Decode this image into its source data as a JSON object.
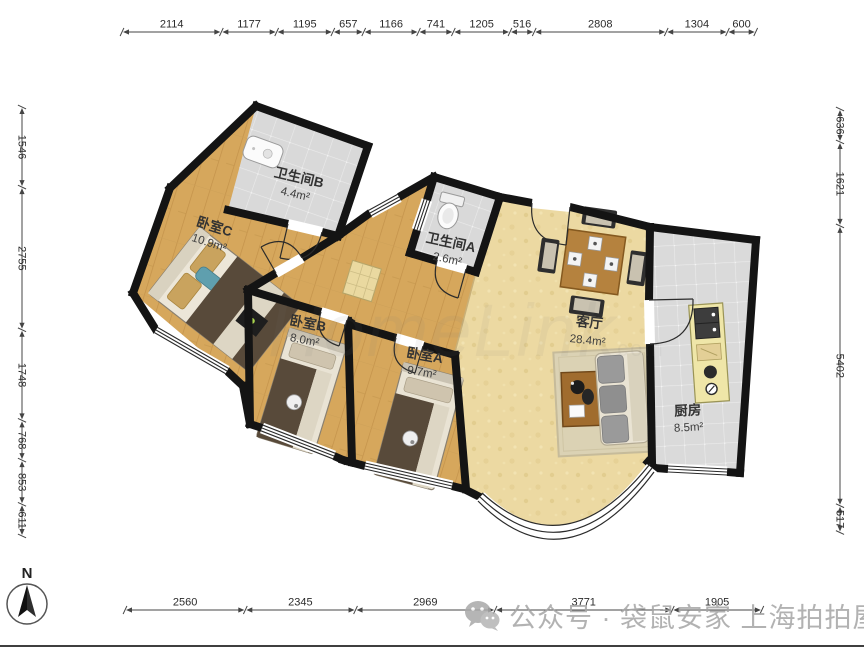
{
  "rooms": [
    {
      "name": "卫生间B",
      "area": "4.4m²"
    },
    {
      "name": "卧室C",
      "area": "10.9m²"
    },
    {
      "name": "卫生间A",
      "area": "2.6m²"
    },
    {
      "name": "卧室B",
      "area": "8.0m²"
    },
    {
      "name": "卧室A",
      "area": "9.7m²"
    },
    {
      "name": "客厅",
      "area": "28.4m²"
    },
    {
      "name": "厨房",
      "area": "8.5m²"
    }
  ],
  "dimensions": {
    "top": [
      2114,
      1177,
      1195,
      657,
      1166,
      741,
      1205,
      516,
      2808,
      1304,
      600
    ],
    "left": [
      1546,
      2755,
      1748,
      768,
      853,
      611
    ],
    "right": [
      636,
      1621,
      5402,
      517
    ],
    "bottom": [
      2560,
      2345,
      2969,
      3771,
      1905
    ]
  },
  "compass": {
    "label": "N"
  },
  "watermark": {
    "bottom_text": "公众号 · 袋鼠安家 上海拍拍屋",
    "center_text": "HomeLink",
    "center_sub": "com"
  },
  "colors": {
    "wall": "#141414",
    "wood_floor": "#d6a75c",
    "living_floor": "#ecd9a2",
    "tile_floor": "#d9d9d9",
    "counter": "#efe6a8",
    "dim_text": "#2b2b2b"
  }
}
